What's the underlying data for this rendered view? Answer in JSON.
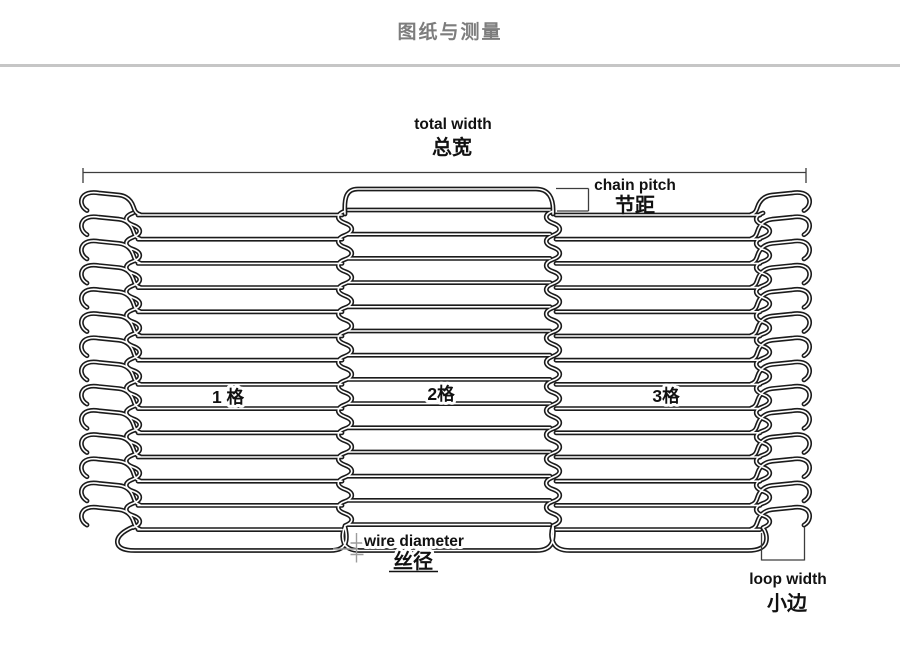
{
  "page": {
    "title": "图纸与测量"
  },
  "colors": {
    "background": "#ffffff",
    "title": "#7d7d7d",
    "divider": "#c6c6c6",
    "wire": "#1b1b1b",
    "wire_core": "#ffffff",
    "dimension": "#3d3d3d",
    "marker": "#9c9c9c",
    "label": "#111111"
  },
  "diagram": {
    "type": "technical-drawing",
    "subject": "balanced weave wire mesh conveyor belt - drawing and measurement",
    "mesh": {
      "rows": 14,
      "sections": 3
    },
    "labels": {
      "total_width": {
        "en": "total width",
        "zh": "总宽"
      },
      "chain_pitch": {
        "en": "chain pitch",
        "zh": "节距"
      },
      "section_1": "1 格",
      "section_2": "2格",
      "section_3": "3格",
      "wire_diameter": {
        "en": "wire diameter",
        "zh": "丝径"
      },
      "loop_width": {
        "en": "loop width",
        "zh": "小边"
      }
    }
  }
}
